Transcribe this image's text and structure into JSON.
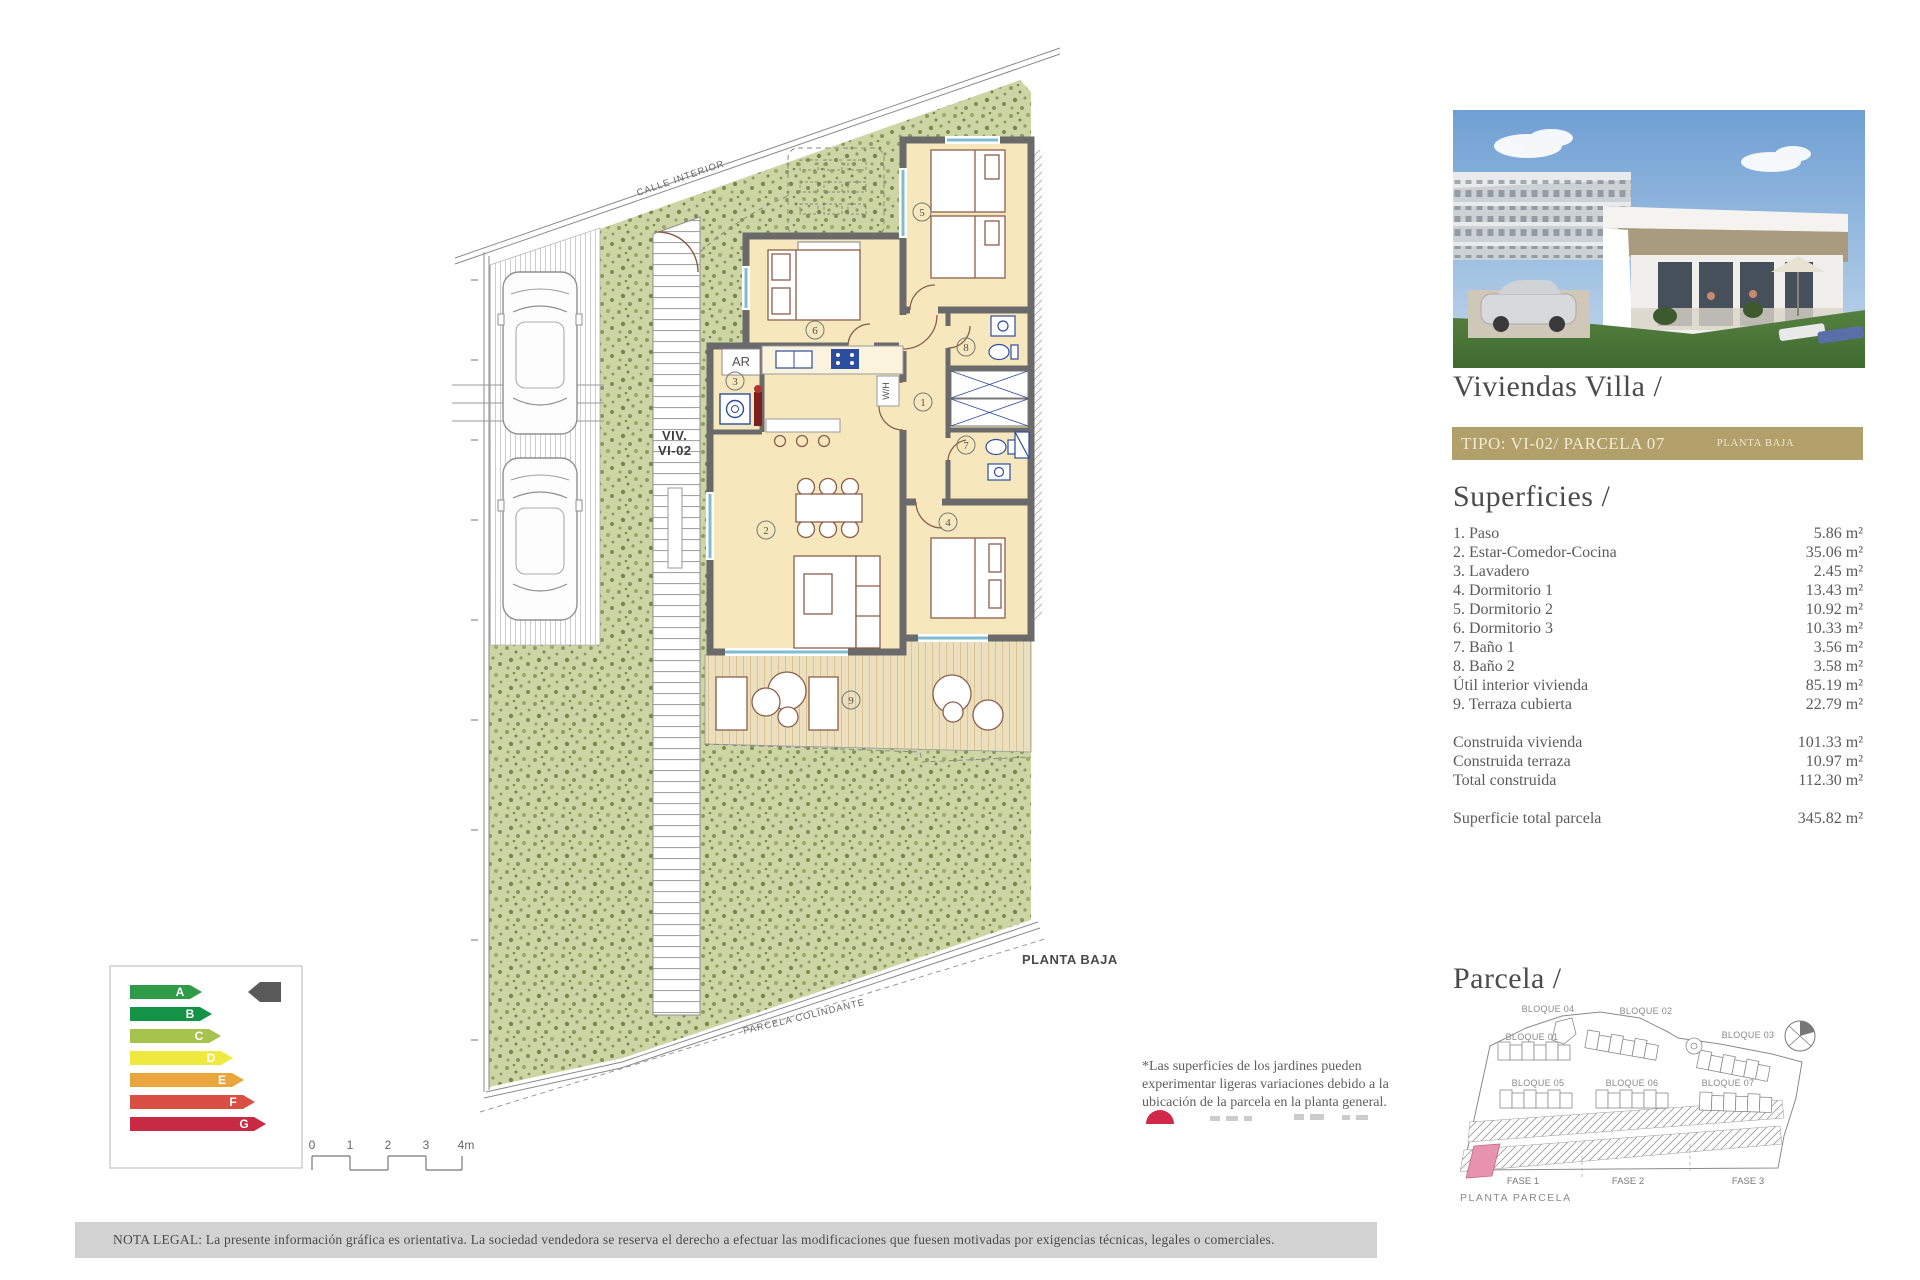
{
  "right_panel": {
    "title": "Viviendas Villa /",
    "tipo_left": "TIPO: VI-02/ PARCELA 07",
    "tipo_right": "PLANTA BAJA",
    "tipo_bar_color": "#b2a06b",
    "superficies_heading": "Superficies /",
    "rows": [
      {
        "label": "1. Paso",
        "value": "5.86 m²"
      },
      {
        "label": "2. Estar-Comedor-Cocina",
        "value": "35.06 m²"
      },
      {
        "label": "3. Lavadero",
        "value": "2.45 m²"
      },
      {
        "label": "4. Dormitorio 1",
        "value": "13.43 m²"
      },
      {
        "label": "5. Dormitorio 2",
        "value": "10.92 m²"
      },
      {
        "label": "6. Dormitorio 3",
        "value": "10.33 m²"
      },
      {
        "label": "7. Baño 1",
        "value": "3.56 m²"
      },
      {
        "label": "8. Baño 2",
        "value": "3.58 m²"
      },
      {
        "label": "Útil interior vivienda",
        "value": "85.19 m²"
      },
      {
        "label": "9. Terraza cubierta",
        "value": "22.79 m²"
      }
    ],
    "totals": [
      {
        "label": "Construida vivienda",
        "value": "101.33 m²"
      },
      {
        "label": "Construida terraza",
        "value": "10.97 m²"
      },
      {
        "label": "Total construida",
        "value": "112.30 m²"
      }
    ],
    "total_parcela": {
      "label": "Superficie total parcela",
      "value": "345.82 m²"
    },
    "parcela_heading": "Parcela /",
    "planta_parcela": "PLANTA PARCELA"
  },
  "plan": {
    "calle_interior": "CALLE INTERIOR",
    "viv_line1": "VIV.",
    "viv_line2": "VI-02",
    "planta_baja": "PLANTA BAJA",
    "parcela_colindante": "PARCELA COLINDANTE",
    "ar_label": "AR",
    "wh_label": "W/H",
    "rooms": [
      "1",
      "2",
      "3",
      "4",
      "5",
      "6",
      "7",
      "8",
      "9"
    ],
    "colors": {
      "grass": "#cdd5a5",
      "wall": "#6a6a6a",
      "room": "#f6e8bc",
      "terrace": "#ecdfbe",
      "fixture_blue": "#2d4d9e",
      "furniture_brown": "#8c5f4a",
      "window_cyan": "#7fbcd2"
    }
  },
  "site_map": {
    "bloques": [
      "BLOQUE 04",
      "BLOQUE 02",
      "BLOQUE 01",
      "BLOQUE 03",
      "BLOQUE 05",
      "BLOQUE 06",
      "BLOQUE 07"
    ],
    "fases": [
      "FASE 1",
      "FASE 2",
      "FASE 3"
    ],
    "highlight_color": "#e793b0"
  },
  "energy": {
    "labels": [
      "A",
      "B",
      "C",
      "D",
      "E",
      "F",
      "G"
    ],
    "colors": [
      "#2f9a47",
      "#149347",
      "#a6c44d",
      "#efe93f",
      "#e9a63c",
      "#da4f43",
      "#c92a43"
    ],
    "pointer_color": "#595959"
  },
  "scale_bar": {
    "ticks": [
      "0",
      "1",
      "2",
      "3",
      "4m"
    ]
  },
  "garden_note": {
    "line1": "*Las superficies de los jardines pueden",
    "line2": "experimentar ligeras variaciones debido a la",
    "line3": "ubicación de la parcela en la planta general.",
    "dot_color": "#d1294a"
  },
  "legal": {
    "text": "NOTA LEGAL: La presente información gráfica es orientativa. La sociedad vendedora se reserva el derecho a efectuar las modificaciones que fuesen motivadas por exigencias técnicas, legales o comerciales."
  }
}
